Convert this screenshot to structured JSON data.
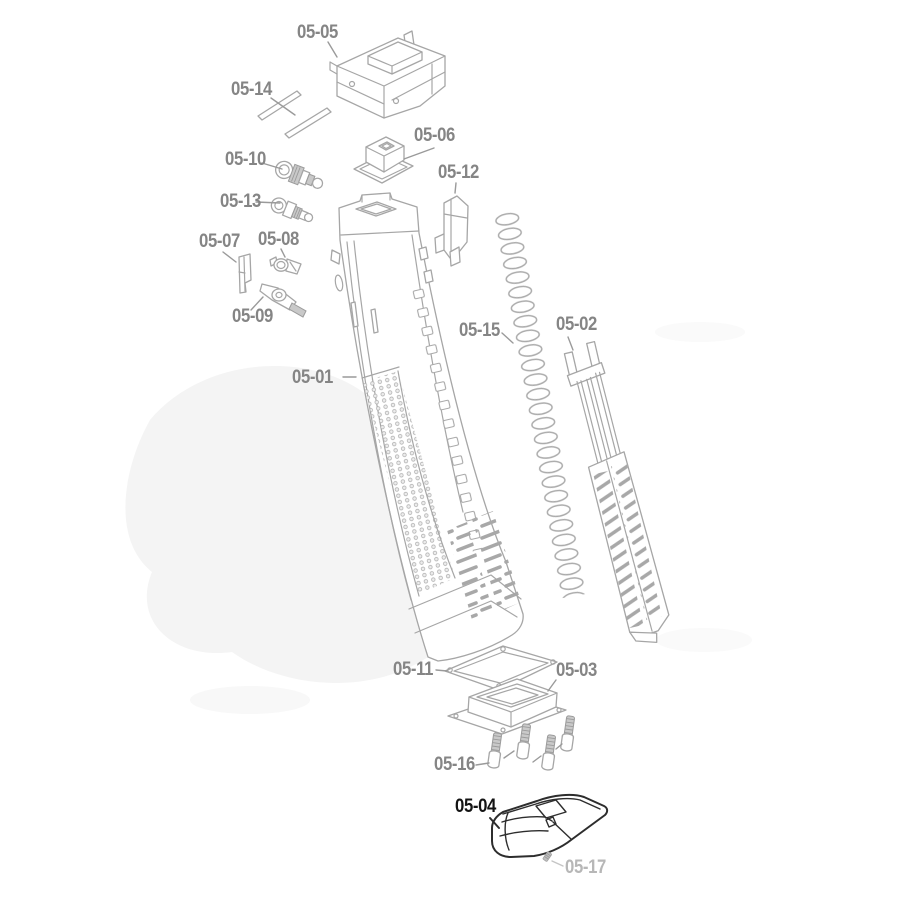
{
  "diagram": {
    "colors": {
      "background": "#ffffff",
      "part_line": "#a6a6a6",
      "metal_fill": "#c9c9c9",
      "label_default": "#858585",
      "label_highlight": "#141414",
      "label_muted": "#b7b7b7",
      "leader_line": "#9a9a9a",
      "highlight_part_line": "#2d2d2d",
      "watermark": "#f4f4f4"
    },
    "parts": [
      {
        "label": "05-05"
      },
      {
        "label": "05-14"
      },
      {
        "label": "05-06"
      },
      {
        "label": "05-10"
      },
      {
        "label": "05-12"
      },
      {
        "label": "05-13"
      },
      {
        "label": "05-07"
      },
      {
        "label": "05-08"
      },
      {
        "label": "05-09"
      },
      {
        "label": "05-15"
      },
      {
        "label": "05-02"
      },
      {
        "label": "05-01"
      },
      {
        "label": "05-11"
      },
      {
        "label": "05-03"
      },
      {
        "label": "05-16"
      },
      {
        "label": "05-04",
        "emphasis": "highlight"
      },
      {
        "label": "05-17",
        "emphasis": "muted"
      }
    ]
  }
}
